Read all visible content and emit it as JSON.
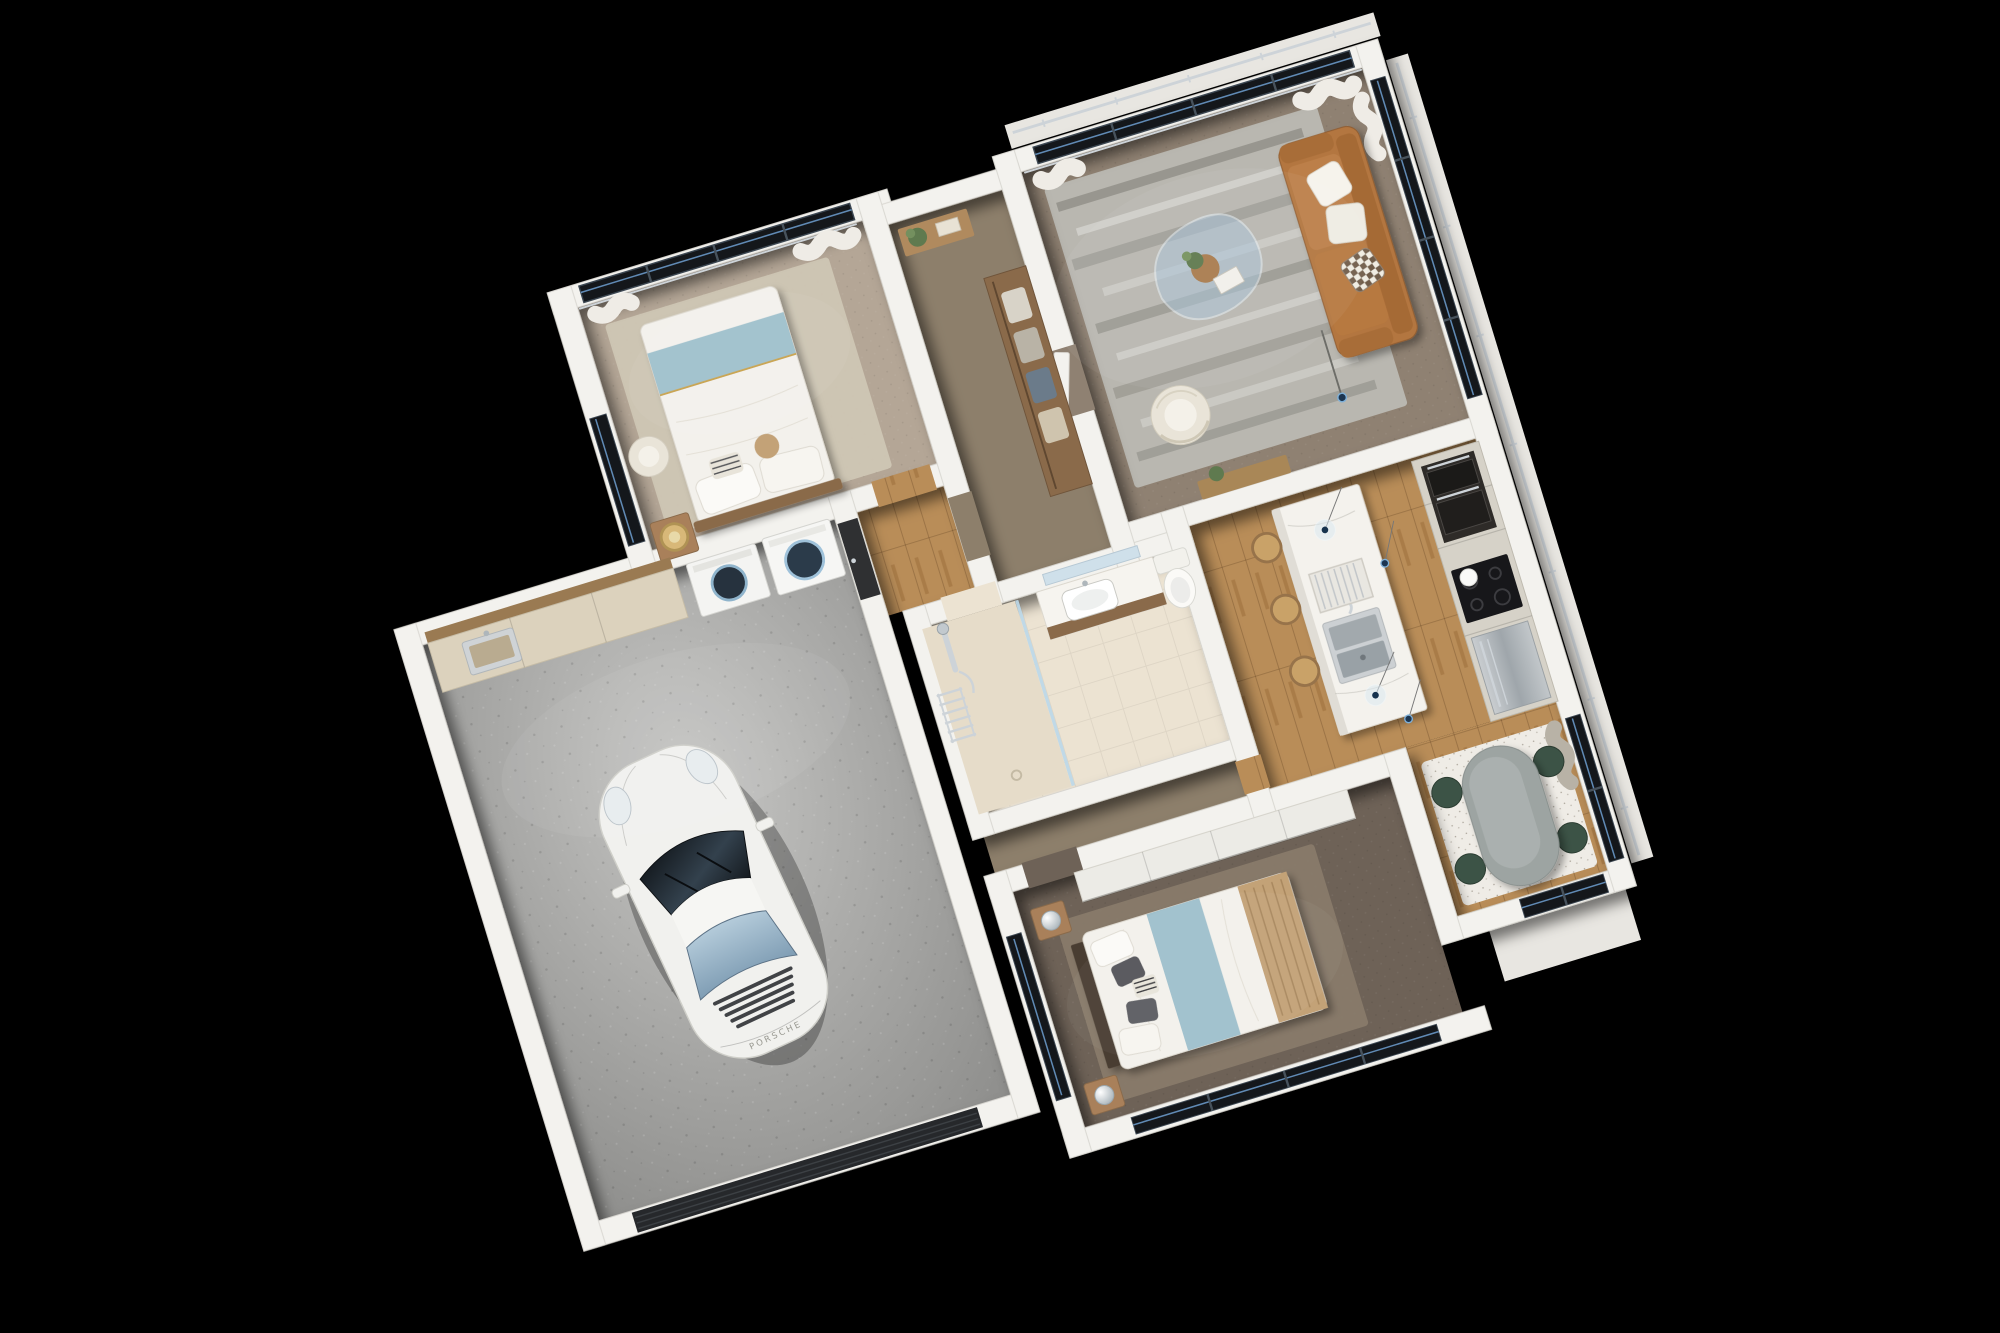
{
  "scene": {
    "type": "photorealistic 3D floor plan render",
    "view": "top-down dollhouse cutaway, plan rotated about -17 degrees",
    "background": "black",
    "residence": "apartment with garage, 2 bedrooms, open living-kitchen-dining, bathroom, laundry and wardrobe hall"
  },
  "car": {
    "badge": "PORSCHE",
    "body_color": "white",
    "type": "911-style sports coupe parked nose-up in garage"
  },
  "palette": {
    "background": "#000000",
    "wall": "#f3f2ee",
    "wall_edge": "#d8d6d0",
    "concrete": "#9d9d9b",
    "wood_floor": "#b5874f",
    "wood_furniture": "#8a6a4a",
    "tile": "#ece3d2",
    "carpet_bed1": "#b4a696",
    "rug_bed1": "#cfc6b4",
    "carpet_hall": "#8d7f6b",
    "carpet_living": "#8f8172",
    "rug_living": "#b9b7b0",
    "carpet_bed2": "#6e6257",
    "rug_bed2": "#8a7c6c",
    "glass": "#14171b",
    "glass_accent": "#6e9fd0",
    "curtain": "#efece6",
    "curtain_gray": "#b8b2a6",
    "sofa": "#b3763f",
    "armchair": "#e9e4d8",
    "chair_green": "#3c5346",
    "table_gray": "#9da4a2",
    "island": "#f4f2ed",
    "cabinet": "#d6d2c8",
    "appliance_dark": "#2e2b28",
    "stainless": "#b8bcbf",
    "bed_white": "#f3f1ec",
    "bed_blue": "#9fc0cc",
    "throw_tan": "#c3a277",
    "headboard": "#4a3c30",
    "chrome": "#cdd3d8",
    "plant": "#5f7a4f",
    "garage_door": "#26282b",
    "door_dark": "#2f3032",
    "ledge": "#e8e6e1",
    "counter_stone": "#dcd2bd"
  },
  "rooms": [
    {
      "id": "bedroom-1",
      "name": "bedroom (upper left)",
      "floor": "beige carpet with light rug",
      "features": [
        "double bed, white duvet, light-blue runner at foot",
        "pillows and striped accent cushion",
        "wood nightstand with round rattan lamp",
        "cream floor chair",
        "full-height north windows with white curtains",
        "side window on west wall"
      ]
    },
    {
      "id": "hallway-wardrobe",
      "name": "hall with open wardrobe",
      "floor": "brown carpet and oak entry",
      "features": [
        "wood wardrobe with hanging clothes",
        "console niche with potted plant",
        "white panel door to living room"
      ]
    },
    {
      "id": "living-room",
      "name": "living room",
      "floor": "gray-brown carpet with streaked area rug",
      "features": [
        "cognac 3-seat sofa",
        "two white cushions and diamond-pattern cushion",
        "organic glass coffee table with plant and book",
        "striped cream barrel chair",
        "slim floor lamp",
        "floor-to-ceiling windows with sheer curtains",
        "balcony ledge with chrome rail"
      ]
    },
    {
      "id": "kitchen",
      "name": "open kitchen",
      "floor": "oak planks",
      "features": [
        "white marble island with double stainless sink and drying rack",
        "3 wooden bar stools",
        "glass globe pendant lights on thin wires",
        "tall cabinet run",
        "double wall ovens",
        "black cooktop with white globe pendant",
        "stainless fridge"
      ]
    },
    {
      "id": "dining-area",
      "name": "dining nook",
      "floor": "oak planks with flecked rug",
      "features": [
        "gray oval pedestal table",
        "4 dark-green velvet chairs",
        "east windows with gray curtain",
        "glass door to white porch slab"
      ]
    },
    {
      "id": "bathroom",
      "name": "bathroom",
      "floor": "beige tile",
      "features": [
        "walk-in shower with glass screen",
        "chrome shower set",
        "chrome towel radiator",
        "wood vanity with white basin and mirror",
        "toilet"
      ]
    },
    {
      "id": "laundry",
      "name": "laundry corner of garage",
      "floor": "concrete",
      "features": [
        "stone counter with inset sink",
        "gray base cabinet",
        "wood open shelves",
        "washing machine",
        "tumble dryer",
        "dark entry door with chrome handle"
      ]
    },
    {
      "id": "garage",
      "name": "garage",
      "floor": "concrete",
      "features": [
        "white Porsche sports car",
        "dark sectional garage door"
      ]
    },
    {
      "id": "bedroom-2",
      "name": "bedroom (bottom)",
      "floor": "dark taupe carpet with soft rug",
      "features": [
        "double bed: white duvet, wide light-blue runner, woven tan throw",
        "dark wood headboard",
        "gray, striped and white pillows",
        "two nightstands with chrome sphere lamps",
        "white sliding-door wardrobe",
        "south windows and tall west window"
      ]
    }
  ]
}
